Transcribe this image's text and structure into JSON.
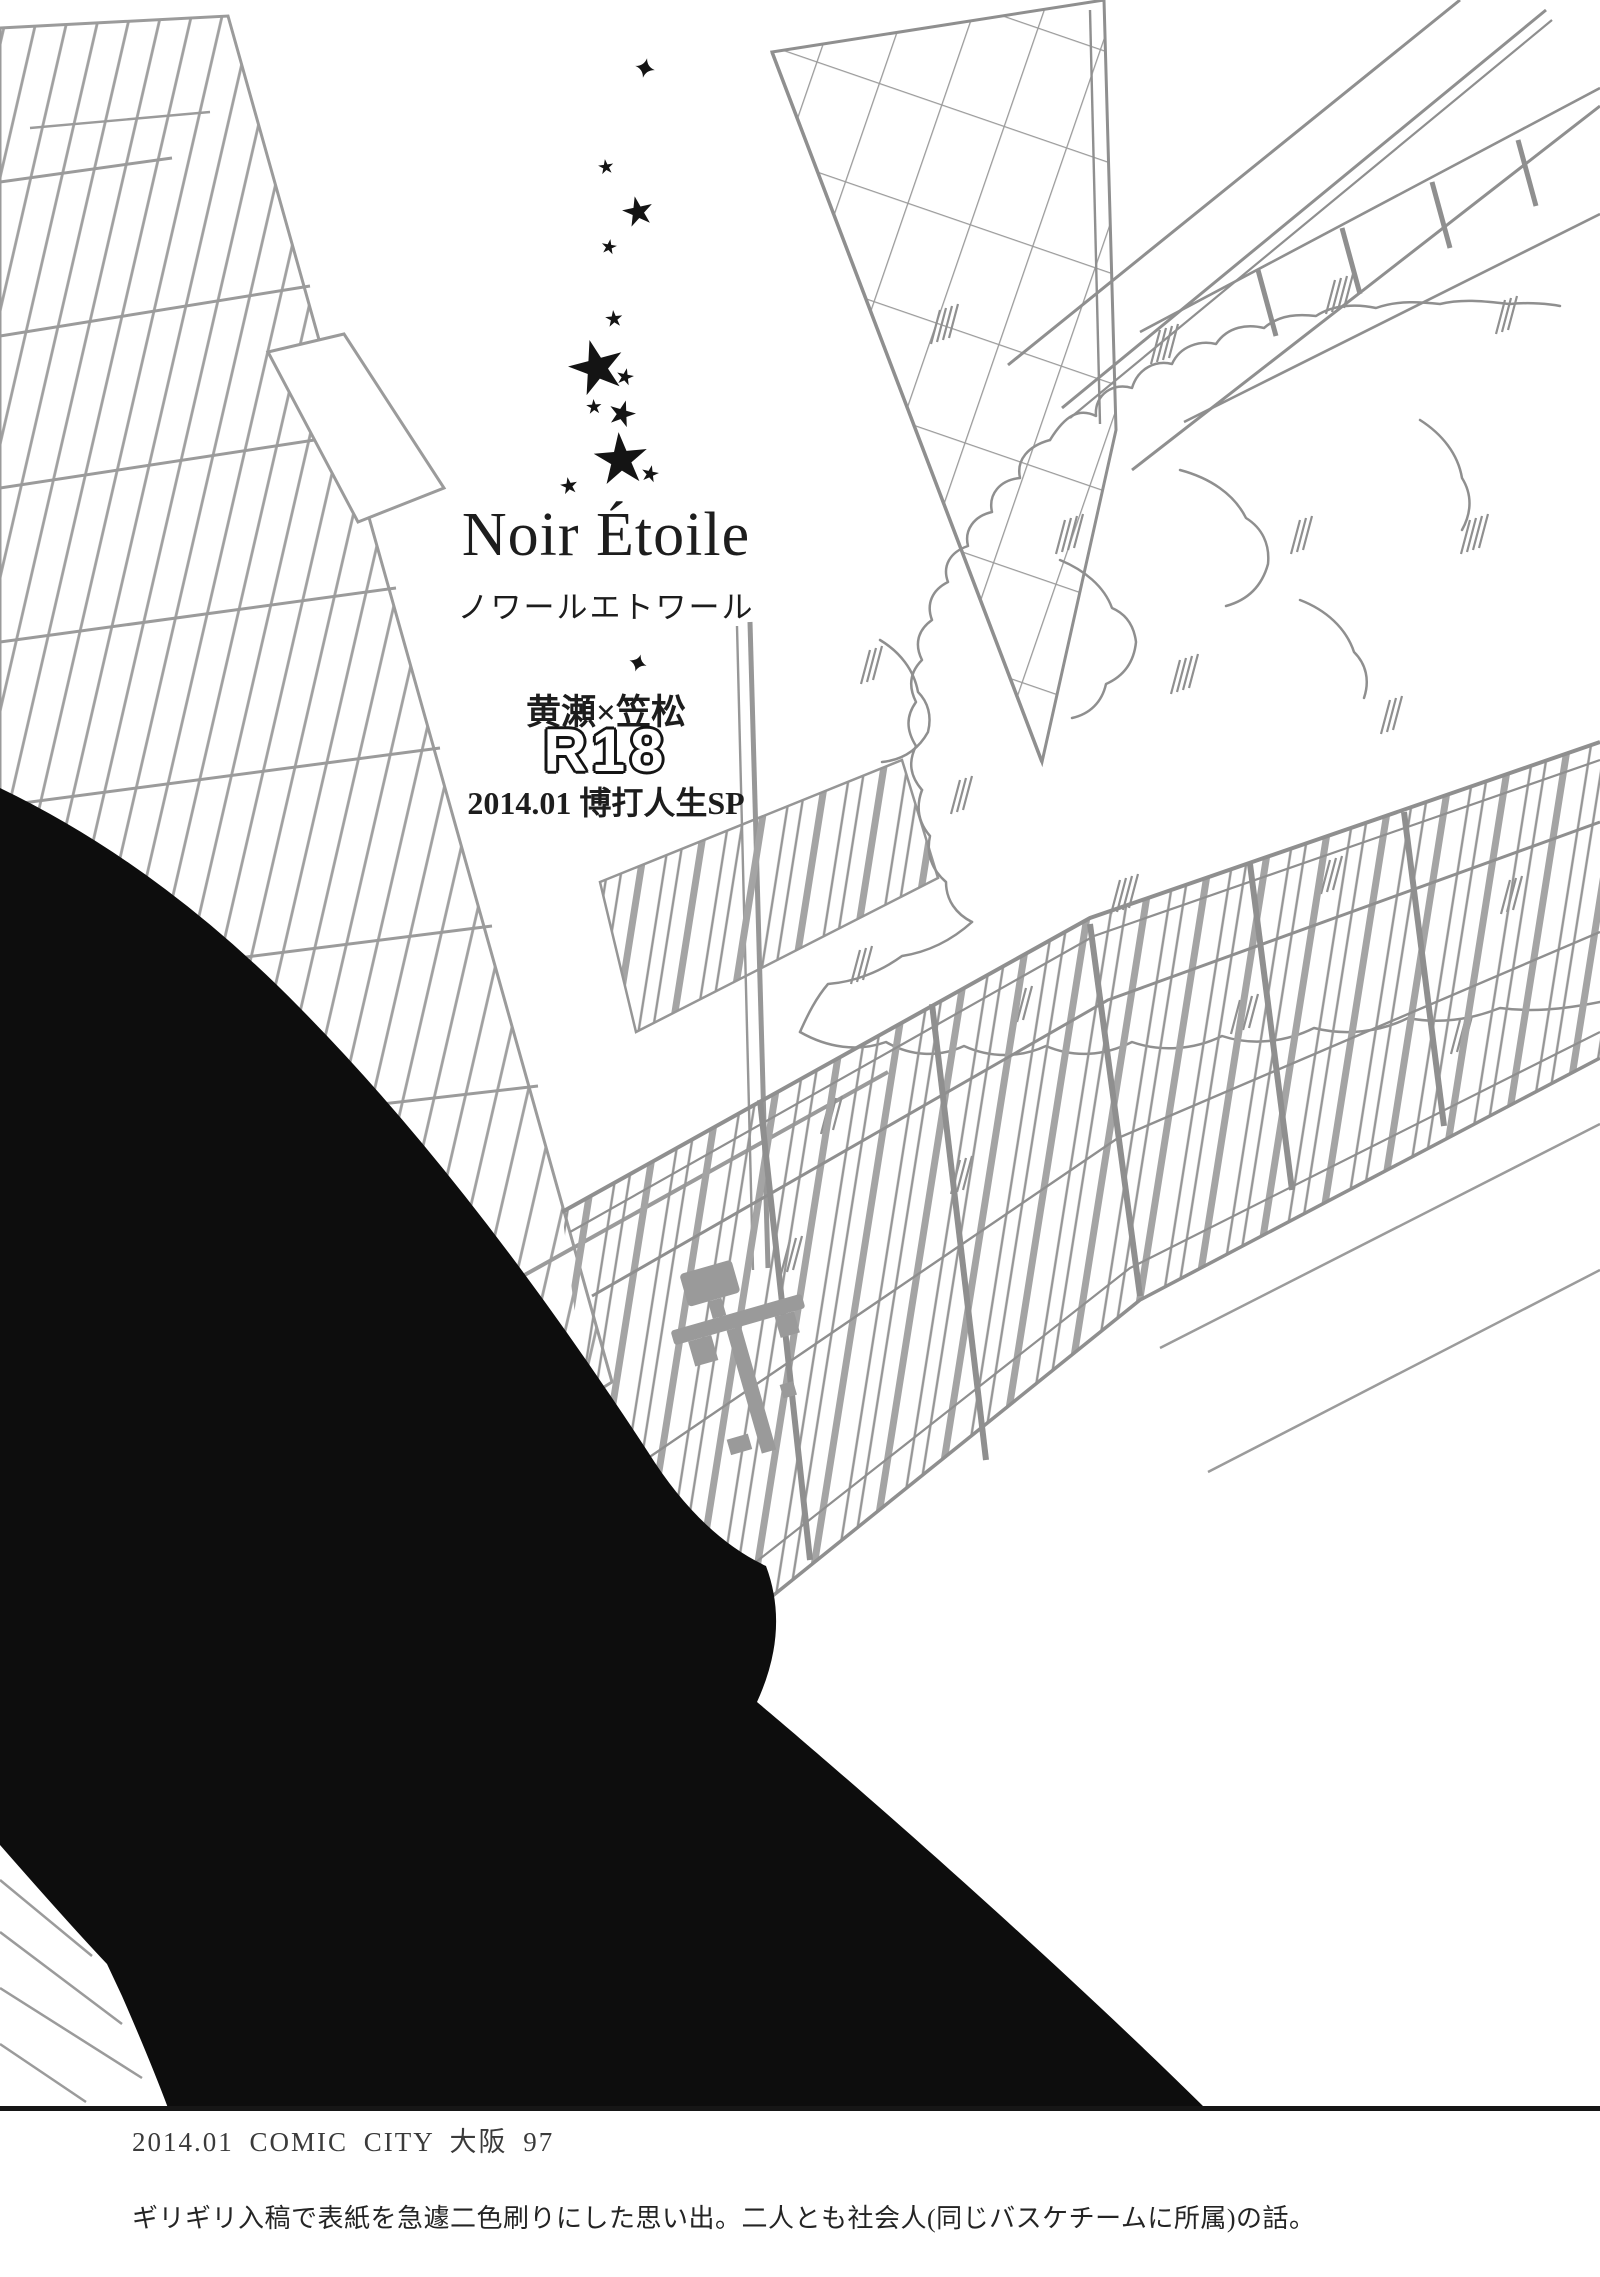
{
  "page_type": "doujinshi credit page (monochrome print)",
  "title_block": {
    "title": "Noir Étoile",
    "title_reading": "ノワールエトワール",
    "pairing": "黄瀬×笠松",
    "rating": "R18",
    "event_line": "2014.01 博打人生SP"
  },
  "footer": {
    "event_credit": "2014.01 COMIC CITY 大阪 97",
    "afterword": "ギリギリ入稿で表紙を急遽二色刷りにした思い出。二人とも社会人(同じバスケチームに所属)の話。"
  },
  "artwork": {
    "description": "gray pen line-art cityscape (tilted buildings, overpass beam, bushy tree, slatted fence, streetlight) with a large black silhouette sweeping across the lower left, a column of black stars above the title, and a thin rule line above the footer",
    "star_count": 13,
    "colors": {
      "ink": "#1d1d1d",
      "line_art": "#9b9b9b",
      "silhouette": "#0d0d0d",
      "rule_line": "#161616",
      "paper": "#ffffff"
    }
  }
}
